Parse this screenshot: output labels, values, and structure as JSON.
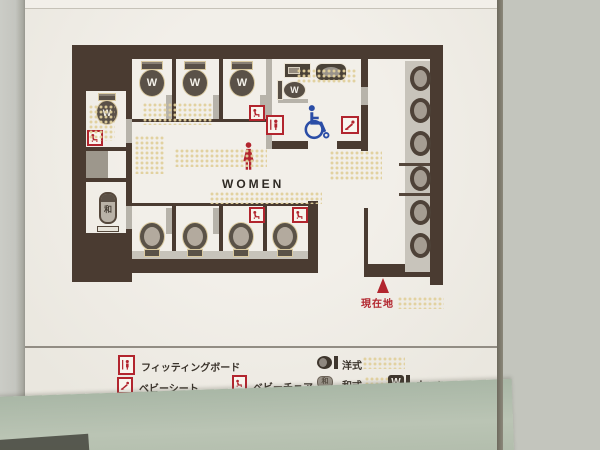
{
  "sign": {
    "area_label": "WOMEN",
    "you_are_here_label": "現在地",
    "washlet_letter": "W",
    "japanese_letter": "和"
  },
  "legend": {
    "fitting_board": "フィッティングボード",
    "baby_sheet": "ベビーシート",
    "baby_chair": "ベビーチェア",
    "western_style": "洋式",
    "japanese_style": "和式",
    "washlet": "ウォシュレット付"
  },
  "facilities": {
    "top_row_washlet_stalls": 3,
    "bottom_row_western_stalls": 4,
    "side_washlet_stalls": 1,
    "side_japanese_stalls": 1,
    "accessible_rooms": 1,
    "sinks": 6,
    "baby_chair_marks": 4,
    "baby_sheet_marks": 1,
    "fitting_board_marks": 1
  },
  "colors": {
    "wall": "#4a3b31",
    "board": "#efece5",
    "accent_red": "#b2252e",
    "accessible_blue": "#2b4da6",
    "braille_dot": "#e1d09c",
    "glass_green": "#9aa18f"
  }
}
